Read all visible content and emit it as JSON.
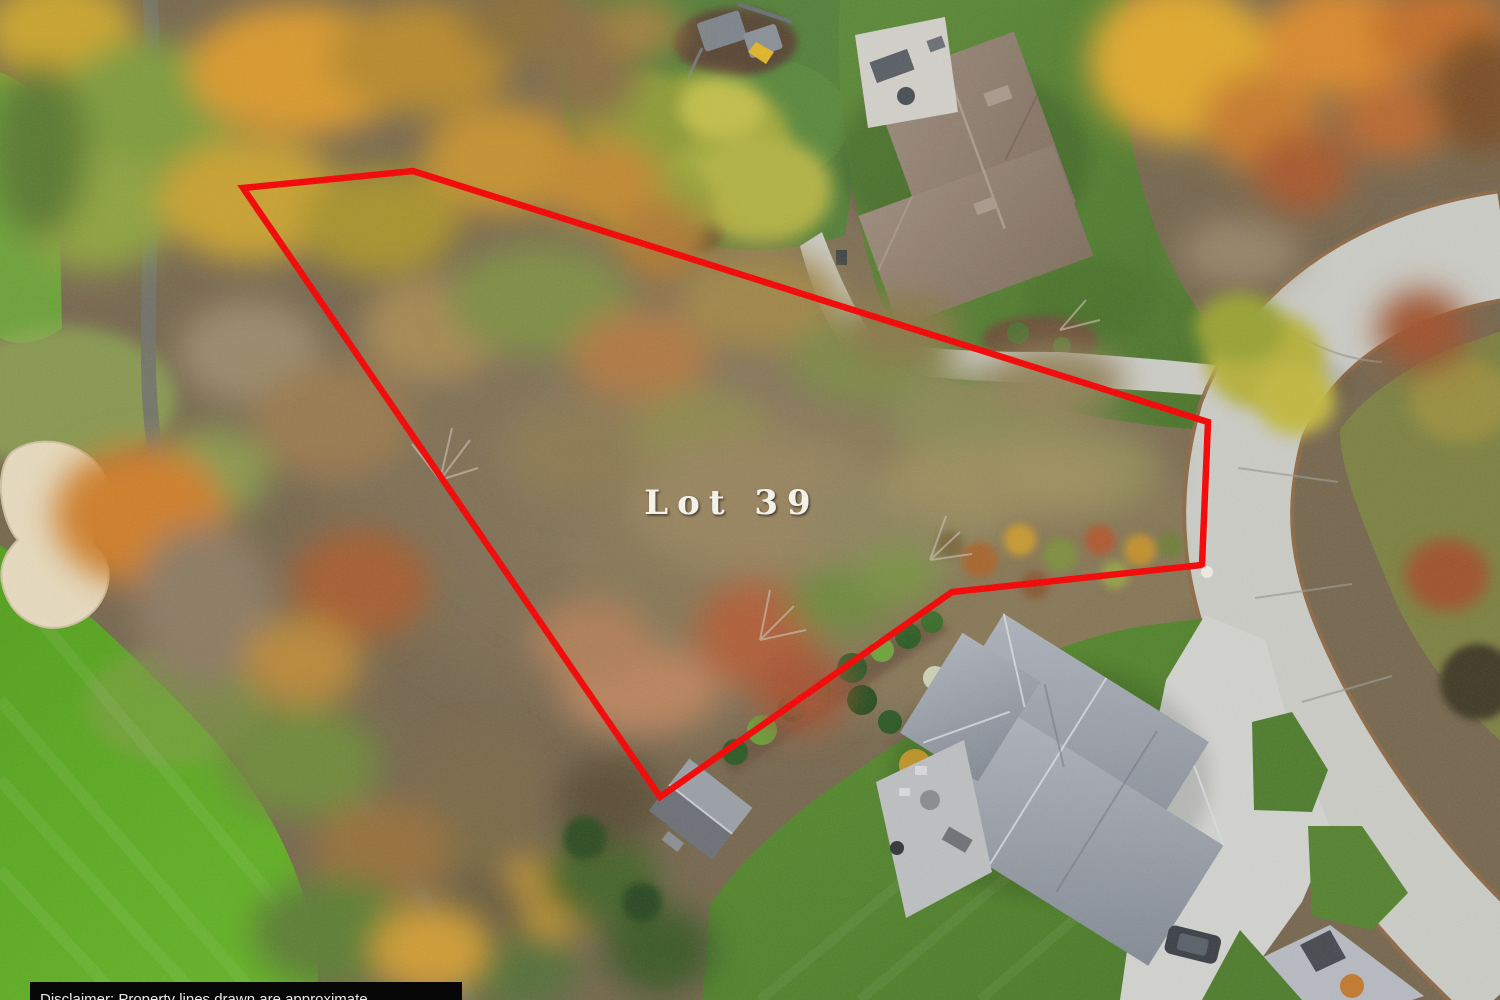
{
  "image": {
    "type": "aerial-drone-photo",
    "description": "Overhead autumn aerial photo of a wooded vacant homesite outlined in red, between a golf course fairway and a curved residential concrete street with two neighboring homes",
    "width": 1500,
    "height": 1000
  },
  "overlay": {
    "lot_label": "Lot 39",
    "lot_label_color": "#f7f4ec",
    "boundary_color": "#f50404",
    "boundary_marker_color": "#eceae2",
    "disclaimer_bar_color": "#070707",
    "disclaimer_text": "Disclaimer: Property lines drawn are approximate",
    "disclaimer_text_color": "#e9e9e9"
  },
  "scene": {
    "golf_course": {
      "label": "golf-fairway-and-bunker",
      "grass_color": "#58a31f",
      "bunker_color": "#e6dabe",
      "cart_path_color": "#72736b"
    },
    "street": {
      "label": "curved-concrete-street",
      "pavement_color": "#cbccc6",
      "curb_color": "#8f6a47"
    },
    "north_home": {
      "label": "neighbor-home-brown-roof",
      "roof_color": "#93816f",
      "patio_color": "#d2d0c9",
      "driveway_color": "#cdcdc7",
      "lawn_color": "#567f35"
    },
    "south_home": {
      "label": "neighbor-home-gray-roof",
      "roof_color": "#a2a8b0",
      "patio_color": "#bdbfc0",
      "driveway_color": "#d2d3cf",
      "lawn_color": "#54842e",
      "car_color": "#3c4148"
    },
    "shed": {
      "label": "outbuilding-at-lot-corner",
      "roof_color": "#6d7177"
    },
    "lot_interior": {
      "label": "wooded-autumn-scrub-parcel",
      "base_color": "#82725a"
    }
  }
}
